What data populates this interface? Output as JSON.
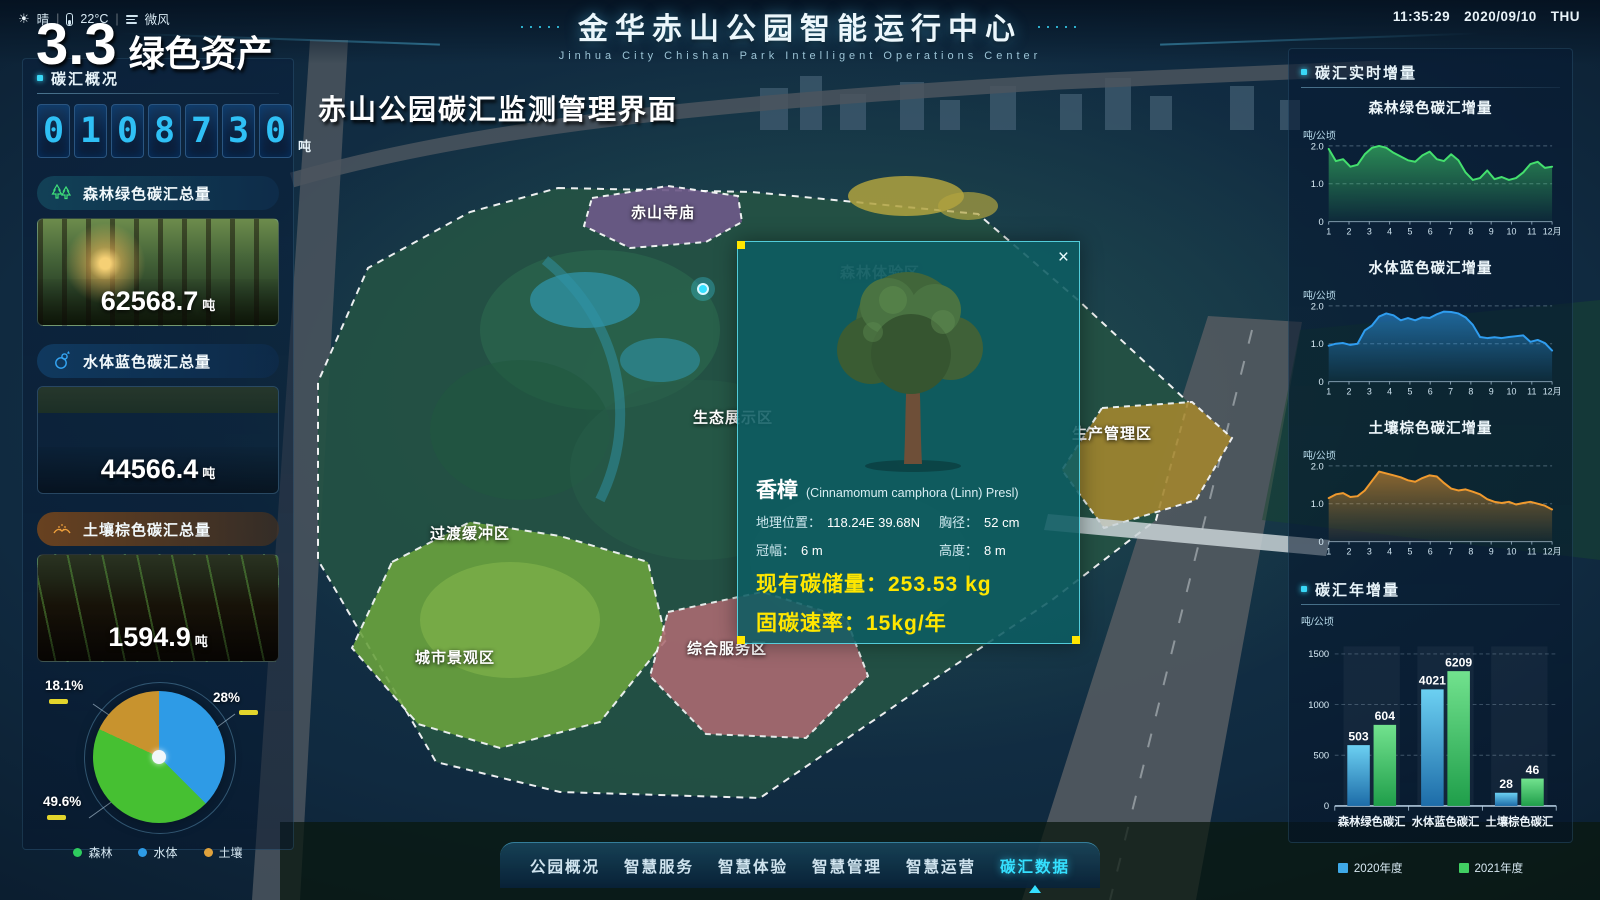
{
  "header": {
    "title": "金华赤山公园智能运行中心",
    "subtitle": "Jinhua City Chishan Park Intelligent Operations Center",
    "dots_left": "·····",
    "dots_right": "·····",
    "weather": {
      "condition": "晴",
      "temperature": "22°C",
      "wind": "微风",
      "separator": "|"
    },
    "clock": {
      "time": "11:35:29",
      "date": "2020/09/10",
      "weekday": "THU"
    }
  },
  "overlay": {
    "section_number": "3.3",
    "section_title": "绿色资产",
    "page_title": "赤山公园碳汇监测管理界面"
  },
  "left_panel": {
    "section_title": "碳汇概况",
    "counter": {
      "digits": [
        "0",
        "1",
        "0",
        "8",
        "7",
        "3",
        "0"
      ],
      "unit": "吨"
    },
    "cards": [
      {
        "id": "forest",
        "title": "森林绿色碳汇总量",
        "value": "62568.7",
        "unit": "吨",
        "icon": "tree-icon",
        "accent": "#3fe07a"
      },
      {
        "id": "water",
        "title": "水体蓝色碳汇总量",
        "value": "44566.4",
        "unit": "吨",
        "icon": "water-icon",
        "accent": "#35a6f5"
      },
      {
        "id": "soil",
        "title": "土壤棕色碳汇总量",
        "value": "1594.9",
        "unit": "吨",
        "icon": "soil-icon",
        "accent": "#f0a13c"
      }
    ]
  },
  "map": {
    "regions": [
      {
        "id": "temple",
        "label": "赤山寺庙"
      },
      {
        "id": "forest-experience",
        "label": "森林体验区"
      },
      {
        "id": "eco-display",
        "label": "生态展示区"
      },
      {
        "id": "transition-buffer",
        "label": "过渡缓冲区"
      },
      {
        "id": "city-landscape",
        "label": "城市景观区"
      },
      {
        "id": "comprehensive-service",
        "label": "综合服务区"
      },
      {
        "id": "production-management",
        "label": "生产管理区"
      }
    ]
  },
  "popup": {
    "close": "×",
    "name": "香樟",
    "latin": "(Cinnamomum camphora (Linn) Presl)",
    "fields": [
      {
        "label": "地理位置：",
        "value": "118.24E 39.68N"
      },
      {
        "label": "胸径：",
        "value": "52 cm"
      },
      {
        "label": "冠幅：",
        "value": "6 m"
      },
      {
        "label": "高度：",
        "value": "8 m"
      }
    ],
    "highlights": [
      {
        "label": "现有碳储量：",
        "value": "253.53 kg"
      },
      {
        "label": "固碳速率：",
        "value": "15kg/年"
      }
    ]
  },
  "right_panel": {
    "realtime_title": "碳汇实时增量",
    "annual_title": "碳汇年增量"
  },
  "nav": {
    "items": [
      {
        "id": "park-overview",
        "label": "公园概况",
        "active": false
      },
      {
        "id": "smart-service",
        "label": "智慧服务",
        "active": false
      },
      {
        "id": "smart-experience",
        "label": "智慧体验",
        "active": false
      },
      {
        "id": "smart-management",
        "label": "智慧管理",
        "active": false
      },
      {
        "id": "smart-operations",
        "label": "智慧运营",
        "active": false
      },
      {
        "id": "carbon-data",
        "label": "碳汇数据",
        "active": true
      }
    ]
  },
  "colors": {
    "accent_cyan": "#35d6f5",
    "highlight_yellow": "#ffe600"
  },
  "chart_data": [
    {
      "id": "carbon-share",
      "type": "pie",
      "legend_position": "bottom",
      "slices": [
        {
          "name": "水体",
          "pct_label": "28%",
          "value": 28,
          "display_deg": 135,
          "color": "#2e9be6"
        },
        {
          "name": "森林",
          "pct_label": "49.6%",
          "value": 49.6,
          "display_deg": 160,
          "color": "#46c032"
        },
        {
          "name": "土壤",
          "pct_label": "18.1%",
          "value": 18.1,
          "display_deg": 65,
          "color": "#c8932e"
        }
      ],
      "legend": [
        {
          "name": "森林",
          "color": "#2ecc5e"
        },
        {
          "name": "水体",
          "color": "#2e9be6"
        },
        {
          "name": "土壤",
          "color": "#e0a23c"
        }
      ]
    },
    {
      "id": "forest-monthly",
      "type": "area",
      "title": "森林绿色碳汇增量",
      "ylabel": "吨/公顷",
      "yticks": [
        0,
        1.0,
        2.0
      ],
      "ylim": [
        0,
        2.3
      ],
      "xticks": [
        "1",
        "2",
        "3",
        "4",
        "5",
        "6",
        "7",
        "8",
        "9",
        "10",
        "11",
        "12月"
      ],
      "color": "#44e06e",
      "values": [
        1.92,
        1.6,
        1.65,
        1.45,
        1.5,
        1.78,
        1.95,
        2.0,
        1.95,
        1.82,
        1.72,
        1.62,
        1.58,
        1.75,
        1.85,
        1.65,
        1.6,
        1.78,
        1.62,
        1.3,
        1.1,
        1.15,
        1.35,
        1.12,
        1.18,
        1.1,
        1.15,
        1.3,
        1.52,
        1.58,
        1.42,
        1.45
      ]
    },
    {
      "id": "water-monthly",
      "type": "area",
      "title": "水体蓝色碳汇增量",
      "ylabel": "吨/公顷",
      "yticks": [
        0,
        1.0,
        2.0
      ],
      "ylim": [
        0,
        2.3
      ],
      "xticks": [
        "1",
        "2",
        "3",
        "4",
        "5",
        "6",
        "7",
        "8",
        "9",
        "10",
        "11",
        "12月"
      ],
      "color": "#2f9df0",
      "values": [
        0.95,
        1.0,
        1.02,
        0.97,
        1.0,
        1.35,
        1.48,
        1.72,
        1.8,
        1.75,
        1.62,
        1.68,
        1.62,
        1.7,
        1.68,
        1.78,
        1.85,
        1.84,
        1.8,
        1.7,
        1.5,
        1.18,
        1.15,
        1.17,
        1.15,
        1.18,
        1.2,
        1.22,
        1.05,
        1.1,
        1.02,
        0.82
      ]
    },
    {
      "id": "soil-monthly",
      "type": "area",
      "title": "土壤棕色碳汇增量",
      "ylabel": "吨/公顷",
      "yticks": [
        0,
        1.0,
        2.0
      ],
      "ylim": [
        0,
        2.3
      ],
      "xticks": [
        "1",
        "2",
        "3",
        "4",
        "5",
        "6",
        "7",
        "8",
        "9",
        "10",
        "11",
        "12月"
      ],
      "color": "#f09a2e",
      "values": [
        1.15,
        1.25,
        1.28,
        1.18,
        1.2,
        1.35,
        1.6,
        1.85,
        1.8,
        1.75,
        1.7,
        1.62,
        1.58,
        1.68,
        1.75,
        1.72,
        1.55,
        1.4,
        1.35,
        1.38,
        1.32,
        1.25,
        1.12,
        1.05,
        1.02,
        1.05,
        0.98,
        1.02,
        1.05,
        1.0,
        0.95,
        0.85
      ]
    },
    {
      "id": "annual",
      "type": "bar",
      "title": "碳汇年增量",
      "ylabel": "吨/公顷",
      "yticks": [
        0,
        500,
        1000,
        1500
      ],
      "ylim": [
        0,
        1500
      ],
      "categories": [
        "森林绿色碳汇",
        "水体蓝色碳汇",
        "土壤棕色碳汇"
      ],
      "series": [
        {
          "name": "2020年度",
          "color": "#3fa9e8",
          "color_top": "#6cd0f2",
          "color_bottom": "#1d6ca8",
          "values": [
            503,
            4021,
            28
          ],
          "display_values": [
            600,
            1150,
            130
          ]
        },
        {
          "name": "2021年度",
          "color": "#41cf62",
          "color_top": "#72e28e",
          "color_bottom": "#1f9e4a",
          "values": [
            604,
            6209,
            46
          ],
          "display_values": [
            800,
            1330,
            270
          ]
        }
      ]
    }
  ]
}
